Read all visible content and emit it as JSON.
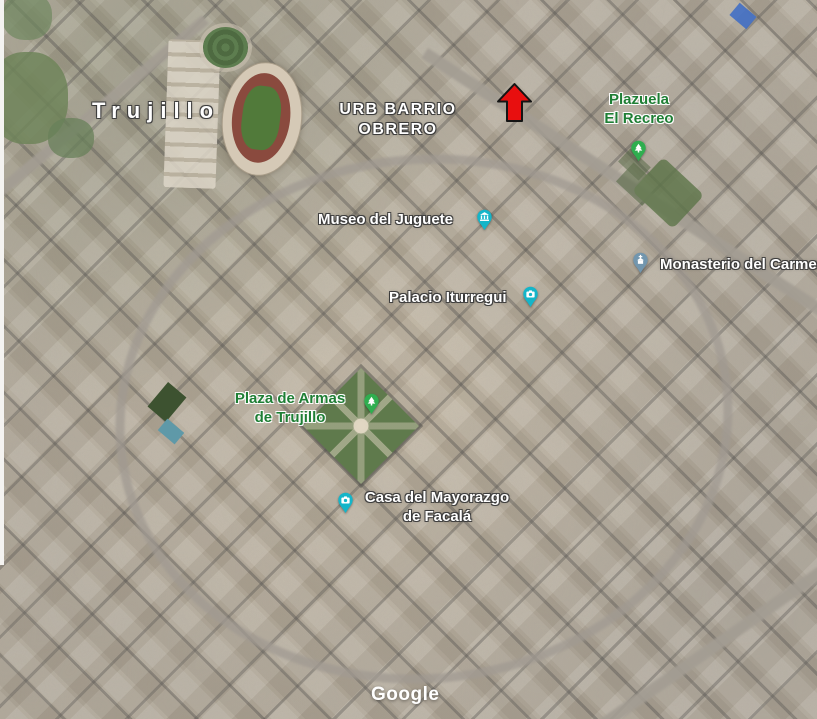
{
  "map": {
    "city": {
      "label": "Trujillo"
    },
    "district": {
      "line1": "URB BARRIO",
      "line2": "OBRERO"
    },
    "pois": {
      "plazuela_el_recreo": {
        "line1": "Plazuela",
        "line2": "El Recreo"
      },
      "museo_del_juguete": {
        "label": "Museo del Juguete"
      },
      "monasterio_del_carmen": {
        "label": "Monasterio del Carmen"
      },
      "palacio_iturregui": {
        "label": "Palacio Iturregui"
      },
      "plaza_de_armas": {
        "line1": "Plaza de Armas",
        "line2": "de Trujillo"
      },
      "casa_del_mayorazgo": {
        "line1": "Casa del Mayorazgo",
        "line2": "de Facalá"
      }
    },
    "annotation": {
      "type": "arrow-up",
      "color": "#E80F0F",
      "outline": "#141414"
    },
    "colors": {
      "park_pin": "#2FAE4F",
      "attraction_pin": "#14B5C9",
      "church_pin": "#7296AE",
      "park_label": "#1E7E34",
      "poi_label": "#FFFFFF"
    },
    "watermark": "Google"
  }
}
